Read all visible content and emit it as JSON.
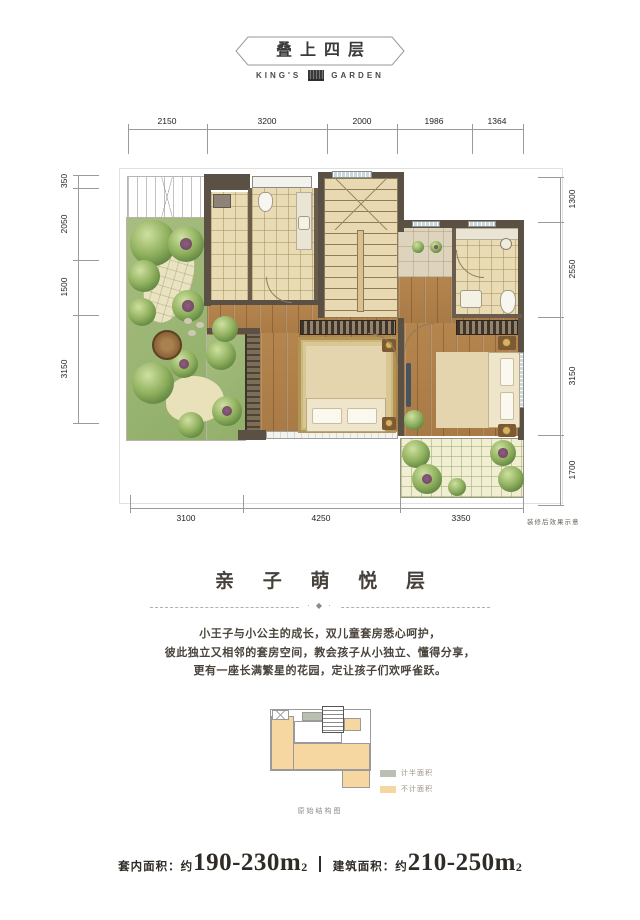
{
  "header": {
    "title": "叠上四层",
    "brand_left": "KING'S",
    "brand_right": "GARDEN"
  },
  "floorplan": {
    "dims_top": [
      "2150",
      "3200",
      "2000",
      "1986",
      "1364"
    ],
    "dims_left": [
      "350",
      "2050",
      "1500",
      "3150"
    ],
    "dims_right": [
      "1300",
      "2550",
      "3150",
      "1700"
    ],
    "dims_bottom": [
      "3100",
      "4250",
      "3350"
    ],
    "note": "装修后效果示意"
  },
  "section": {
    "title": "亲 子 萌 悦 层",
    "divider_ornament": "· ◆ ·",
    "lines": [
      "小王子与小公主的成长，双儿童套房悉心呵护，",
      "彼此独立又相邻的套房空间，教会孩子从小独立、懂得分享，",
      "更有一座长满繁星的花园，定让孩子们欢呼雀跃。"
    ]
  },
  "inset": {
    "legend": [
      {
        "label": "计半面积",
        "color": "#b9c0b2"
      },
      {
        "label": "不计面积",
        "color": "#f6d7a2"
      }
    ],
    "caption": "原始结构图"
  },
  "footer": {
    "area1_label": "套内面积：约",
    "area1_value": "190-230m",
    "area1_sup": "2",
    "area2_label": "建筑面积：约",
    "area2_value": "210-250m",
    "area2_sup": "2"
  },
  "colors": {
    "wall": "#5b5044",
    "wood_floor": "#b08049",
    "bath_tile": "#e9dcb4",
    "garden_green": "#97b26e",
    "legend_half": "#b9c0b2",
    "legend_excluded": "#f6d7a2"
  }
}
